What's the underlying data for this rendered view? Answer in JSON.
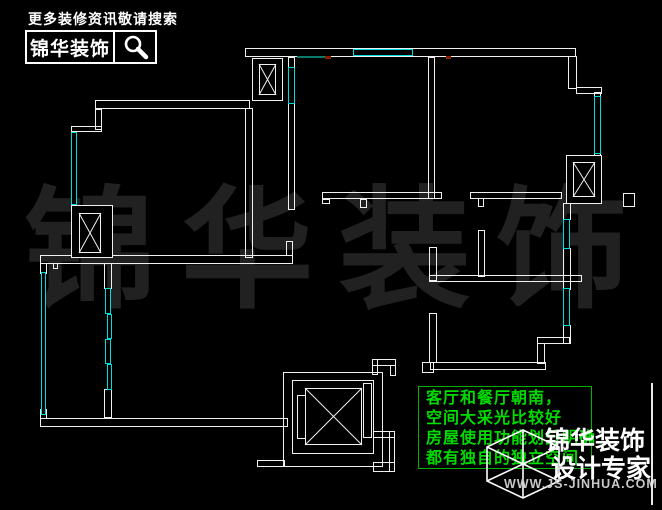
{
  "header": {
    "slogan": "更多装修资讯敬请搜索",
    "brand": "锦华装饰",
    "search_icon": "magnifier-icon"
  },
  "watermark": {
    "chars": [
      "锦",
      "华",
      "装",
      "饰"
    ],
    "color": "#212121"
  },
  "annotation": {
    "border_color": "#00b400",
    "text_color": "#00dc00",
    "lines": [
      "客厅和餐厅朝南，",
      "空间大采光比较好",
      "房屋使用功能划分明确",
      "都有独自的独立空间"
    ]
  },
  "footer": {
    "cube_icon": "wireframe-cube-logo-icon",
    "brand_line1": "锦华装饰",
    "brand_line2": "设计专家",
    "website": "WWW.JS-JINHUA.COM"
  },
  "floorplan": {
    "wall_color": "#f0f0f0",
    "window_color": "#00dcdc",
    "walls": [
      [
        95,
        100,
        155,
        9
      ],
      [
        245,
        108,
        8,
        150
      ],
      [
        95,
        109,
        7,
        21
      ],
      [
        71,
        126,
        31,
        6
      ],
      [
        40,
        255,
        253,
        9
      ],
      [
        286,
        241,
        7,
        15
      ],
      [
        288,
        57,
        7,
        11
      ],
      [
        288,
        103,
        7,
        107
      ],
      [
        245,
        48,
        331,
        9
      ],
      [
        568,
        56,
        9,
        33
      ],
      [
        576,
        87,
        26,
        7
      ],
      [
        594,
        92,
        7,
        66
      ],
      [
        563,
        203,
        8,
        17
      ],
      [
        563,
        248,
        8,
        42
      ],
      [
        563,
        325,
        8,
        19
      ],
      [
        537,
        337,
        33,
        7
      ],
      [
        537,
        343,
        8,
        21
      ],
      [
        430,
        362,
        116,
        8
      ],
      [
        422,
        362,
        12,
        11
      ],
      [
        429,
        313,
        8,
        50
      ],
      [
        429,
        275,
        153,
        7
      ],
      [
        429,
        247,
        8,
        34
      ],
      [
        478,
        230,
        7,
        47
      ],
      [
        478,
        198,
        6,
        9
      ],
      [
        322,
        192,
        120,
        7
      ],
      [
        322,
        199,
        8,
        5
      ],
      [
        470,
        192,
        92,
        7
      ],
      [
        360,
        199,
        7,
        9
      ],
      [
        428,
        57,
        7,
        142
      ],
      [
        623,
        193,
        12,
        14
      ],
      [
        104,
        263,
        8,
        26
      ],
      [
        104,
        389,
        8,
        29
      ],
      [
        40,
        418,
        248,
        9
      ],
      [
        40,
        263,
        7,
        11
      ],
      [
        40,
        409,
        7,
        10
      ],
      [
        53,
        263,
        5,
        6
      ],
      [
        372,
        359,
        24,
        7
      ],
      [
        372,
        359,
        6,
        16
      ],
      [
        390,
        365,
        6,
        11
      ],
      [
        373,
        431,
        22,
        7
      ],
      [
        389,
        431,
        6,
        41
      ],
      [
        373,
        462,
        22,
        10
      ],
      [
        257,
        460,
        28,
        7
      ]
    ],
    "windows": [
      [
        71,
        132,
        6,
        73
      ],
      [
        288,
        67,
        7,
        37
      ],
      [
        353,
        49,
        60,
        7
      ],
      [
        594,
        96,
        7,
        58
      ],
      [
        563,
        219,
        7,
        30
      ],
      [
        563,
        288,
        7,
        38
      ],
      [
        41,
        272,
        5,
        143
      ],
      [
        105,
        288,
        6,
        26
      ],
      [
        107,
        314,
        5,
        25
      ],
      [
        105,
        339,
        6,
        25
      ],
      [
        107,
        364,
        5,
        26
      ]
    ],
    "shafts": [
      {
        "outer": [
          252,
          58,
          31,
          43
        ],
        "inner": [
          259,
          64,
          17,
          31
        ]
      },
      {
        "outer": [
          71,
          205,
          42,
          53
        ],
        "inner": [
          79,
          213,
          22,
          40
        ]
      },
      {
        "outer": [
          566,
          155,
          36,
          49
        ],
        "inner": [
          573,
          162,
          22,
          35
        ]
      }
    ],
    "elevator": {
      "rects": [
        [
          283,
          372,
          100,
          95
        ],
        [
          292,
          380,
          82,
          74
        ],
        [
          305,
          388,
          57,
          57
        ],
        [
          297,
          395,
          9,
          44
        ],
        [
          363,
          383,
          9,
          55
        ]
      ],
      "cross": [
        305,
        388,
        57,
        57
      ]
    },
    "marks": [
      {
        "rect": [
          297,
          56,
          30,
          2
        ],
        "color": "#0a7a6a"
      },
      {
        "rect": [
          325,
          56,
          6,
          3
        ],
        "color": "#8a1a00"
      },
      {
        "rect": [
          446,
          56,
          5,
          3
        ],
        "color": "#8a1a00"
      }
    ]
  }
}
